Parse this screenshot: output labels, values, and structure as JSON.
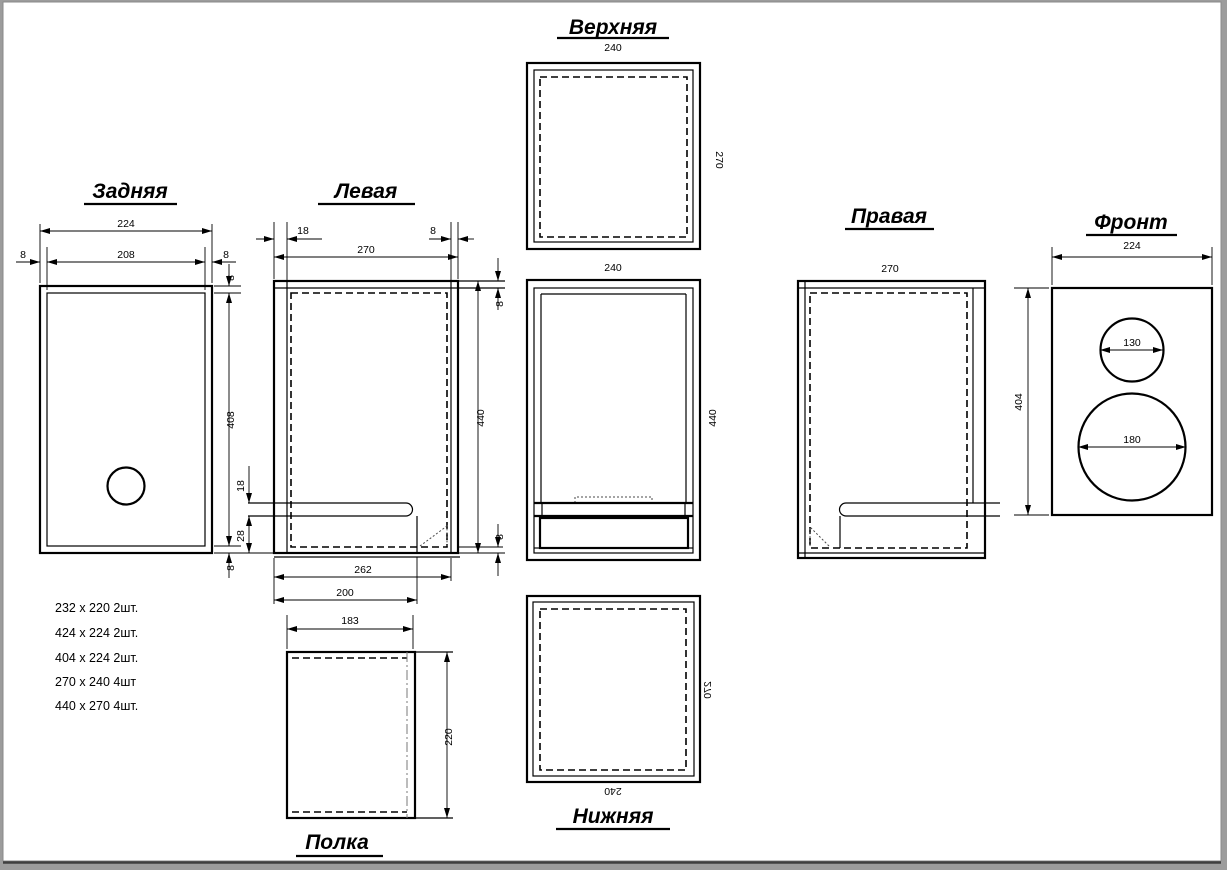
{
  "drawing": {
    "titles": {
      "top": "Верхняя",
      "back": "Задняя",
      "left": "Левая",
      "right": "Правая",
      "front": "Фронт",
      "bottom": "Нижняя",
      "shelf": "Полка"
    },
    "dims": {
      "back": {
        "w": "224",
        "w_in": "208",
        "s_l": "8",
        "s_r": "8",
        "t_top": "8",
        "h": "408",
        "t_bot": "8"
      },
      "left": {
        "front_edge": "18",
        "back_edge": "8",
        "w": "270",
        "t_top": "8",
        "h": "440",
        "t_bot": "8",
        "shelf_t": "18",
        "shelf_off": "28",
        "slot_w": "262",
        "slot_l": "200"
      },
      "top": {
        "w": "240",
        "d": "270"
      },
      "assembly": {
        "w": "240",
        "h": "440"
      },
      "bottom": {
        "w": "240",
        "d": "270"
      },
      "right": {
        "w": "270"
      },
      "front": {
        "w": "224",
        "h": "404",
        "tweeter_d": "130",
        "woofer_d": "180"
      },
      "shelf": {
        "w": "183",
        "d": "220"
      }
    },
    "parts": [
      "232 x 220  2шт.",
      "424 x 224  2шт.",
      "404 x 224  2шт.",
      "270 x 240  4шт",
      "440 x 270  4шт."
    ],
    "colors": {
      "line": "#000000",
      "paper": "#ffffff",
      "frame": "#9c9c9c"
    }
  }
}
